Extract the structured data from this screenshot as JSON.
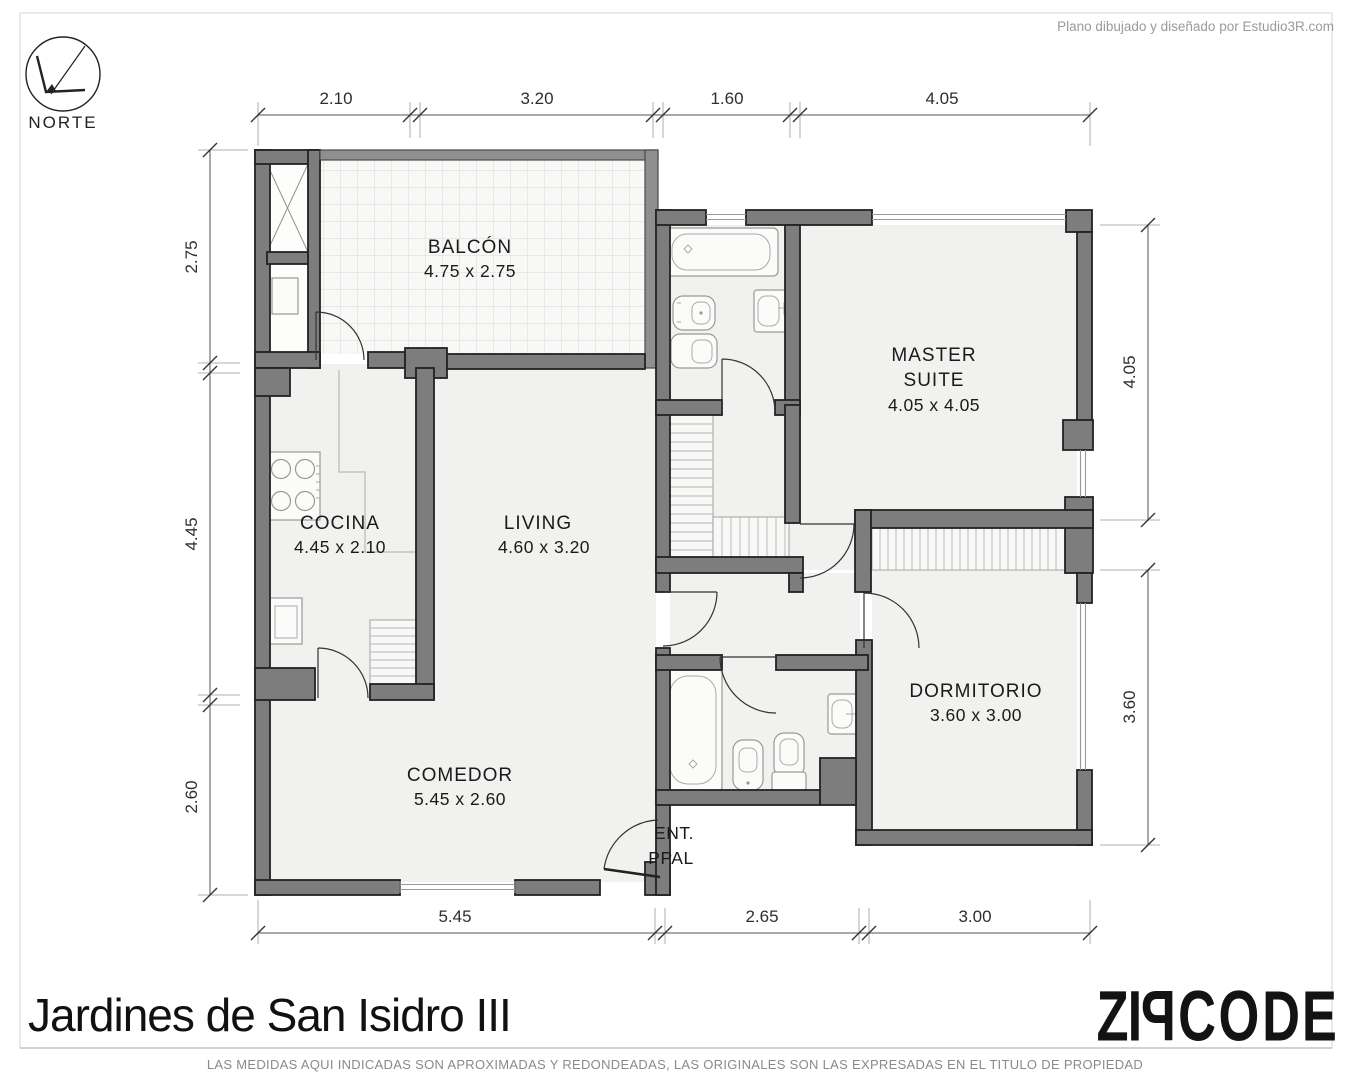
{
  "page": {
    "attribution": "Plano dibujado y diseñado por Estudio3R.com",
    "title": "Jardines de San Isidro III",
    "disclaimer": "LAS MEDIDAS AQUI INDICADAS SON APROXIMADAS Y REDONDEADAS, LAS ORIGINALES SON LAS EXPRESADAS EN EL TITULO DE PROPIEDAD",
    "north_label": "NORTE",
    "logo_letters": [
      "Z",
      "I",
      "P",
      "C",
      "O",
      "D",
      "E"
    ]
  },
  "rooms": {
    "balcon": {
      "name": "BALCÓN",
      "size": "4.75 x 2.75"
    },
    "cocina": {
      "name": "COCINA",
      "size": "4.45 x 2.10"
    },
    "living": {
      "name": "LIVING",
      "size": "4.60 x 3.20"
    },
    "comedor": {
      "name": "COMEDOR",
      "size": "5.45 x 2.60"
    },
    "master_suite": {
      "name_line1": "MASTER",
      "name_line2": "SUITE",
      "size": "4.05 x 4.05"
    },
    "dormitorio": {
      "name": "DORMITORIO",
      "size": "3.60 x 3.00"
    },
    "entrada": {
      "line1": "ENT.",
      "line2": "PPAL"
    }
  },
  "dimensions": {
    "top": [
      "2.10",
      "3.20",
      "1.60",
      "4.05"
    ],
    "left": [
      "2.75",
      "4.45",
      "2.60"
    ],
    "right": [
      "4.05",
      "3.60"
    ],
    "bottom": [
      "5.45",
      "2.65",
      "3.00"
    ]
  },
  "colors": {
    "wall": "#7d7d7d",
    "floor": "#f1f1ef",
    "title_text": "#111111"
  }
}
